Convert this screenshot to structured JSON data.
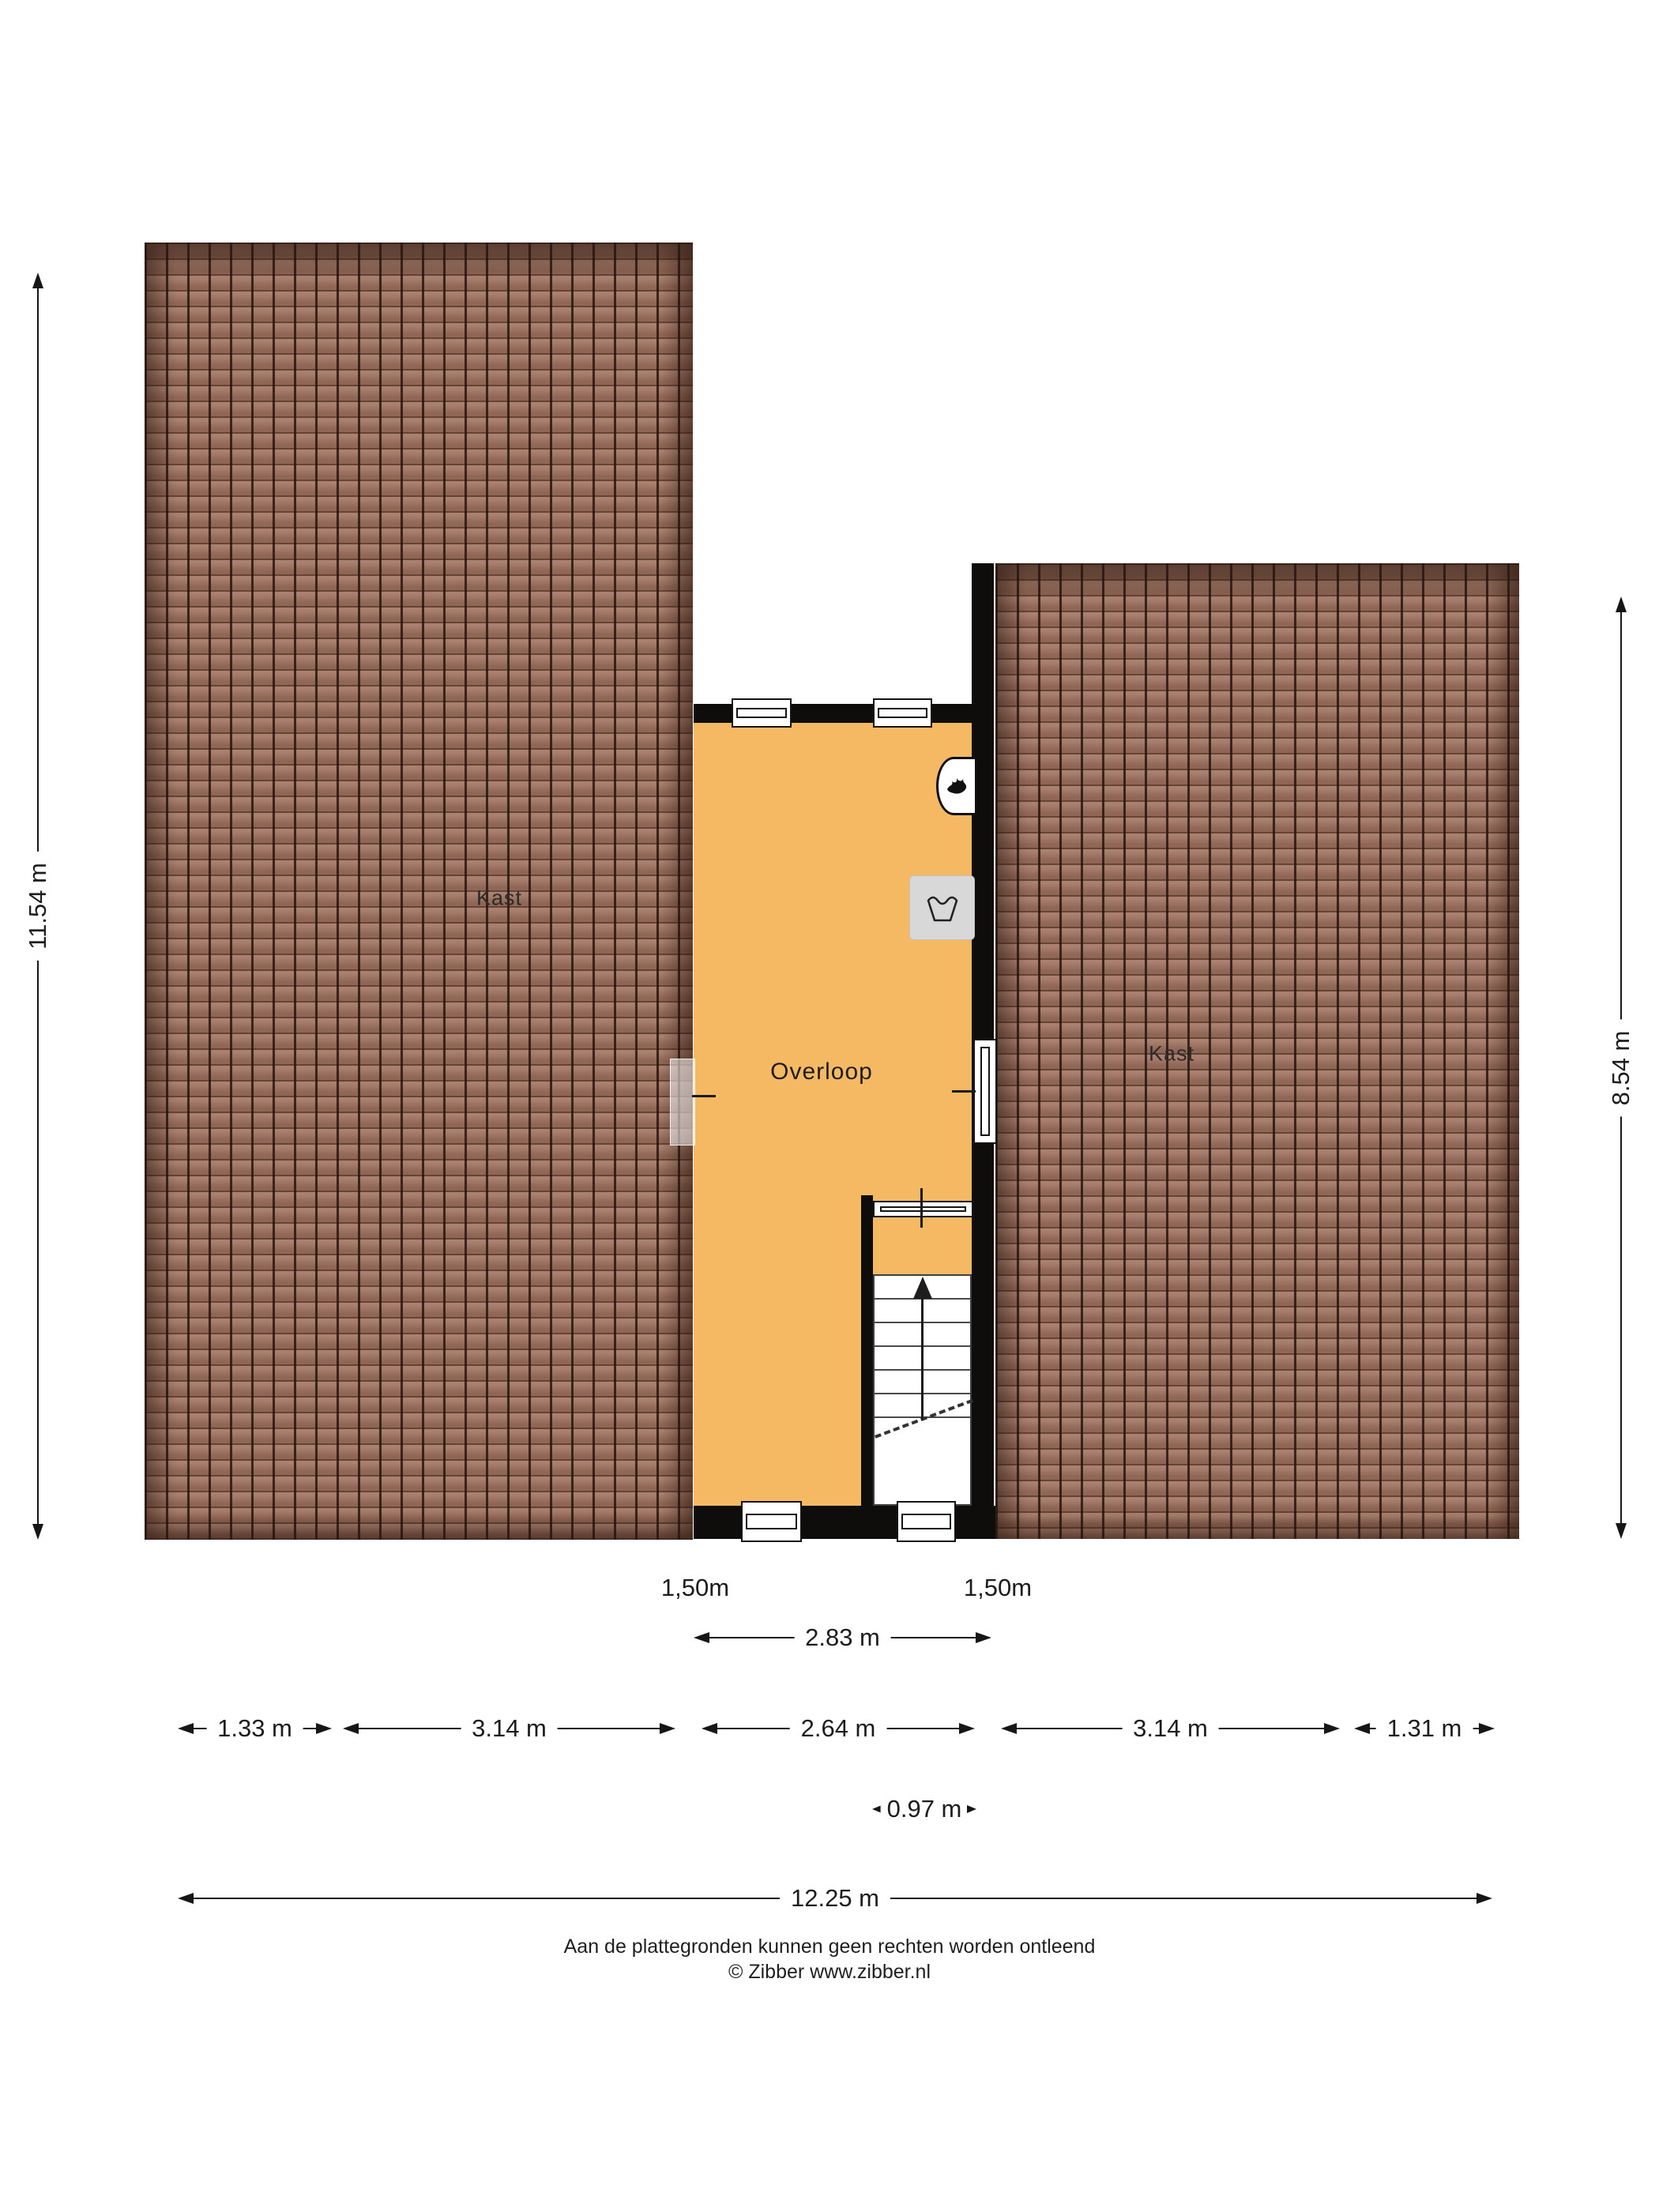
{
  "plan": {
    "kast_left": "Kast",
    "kast_right": "Kast",
    "overloop": "Overloop"
  },
  "dimensions": {
    "height_left": "11.54 m",
    "height_right": "8.54 m",
    "window_left": "1,50m",
    "window_right": "1,50m",
    "overloop_width": "2.83 m",
    "bottom_row": [
      "1.33 m",
      "3.14 m",
      "2.64 m",
      "3.14 m",
      "1.31 m"
    ],
    "stairs_width": "0.97 m",
    "total_width": "12.25 m"
  },
  "icons": {
    "heater": "flame-icon",
    "washer": "laundry-icon",
    "stairs": "up-arrow-icon"
  },
  "colors": {
    "floor": "#f5b963",
    "wall": "#0f0d0c",
    "roof": "#a0725f",
    "roof_line": "#3c2b23",
    "appliance_gray": "#d8d8d8"
  },
  "footer": {
    "disclaimer": "Aan de plattegronden kunnen geen rechten worden ontleend",
    "copyright": "© Zibber www.zibber.nl"
  }
}
